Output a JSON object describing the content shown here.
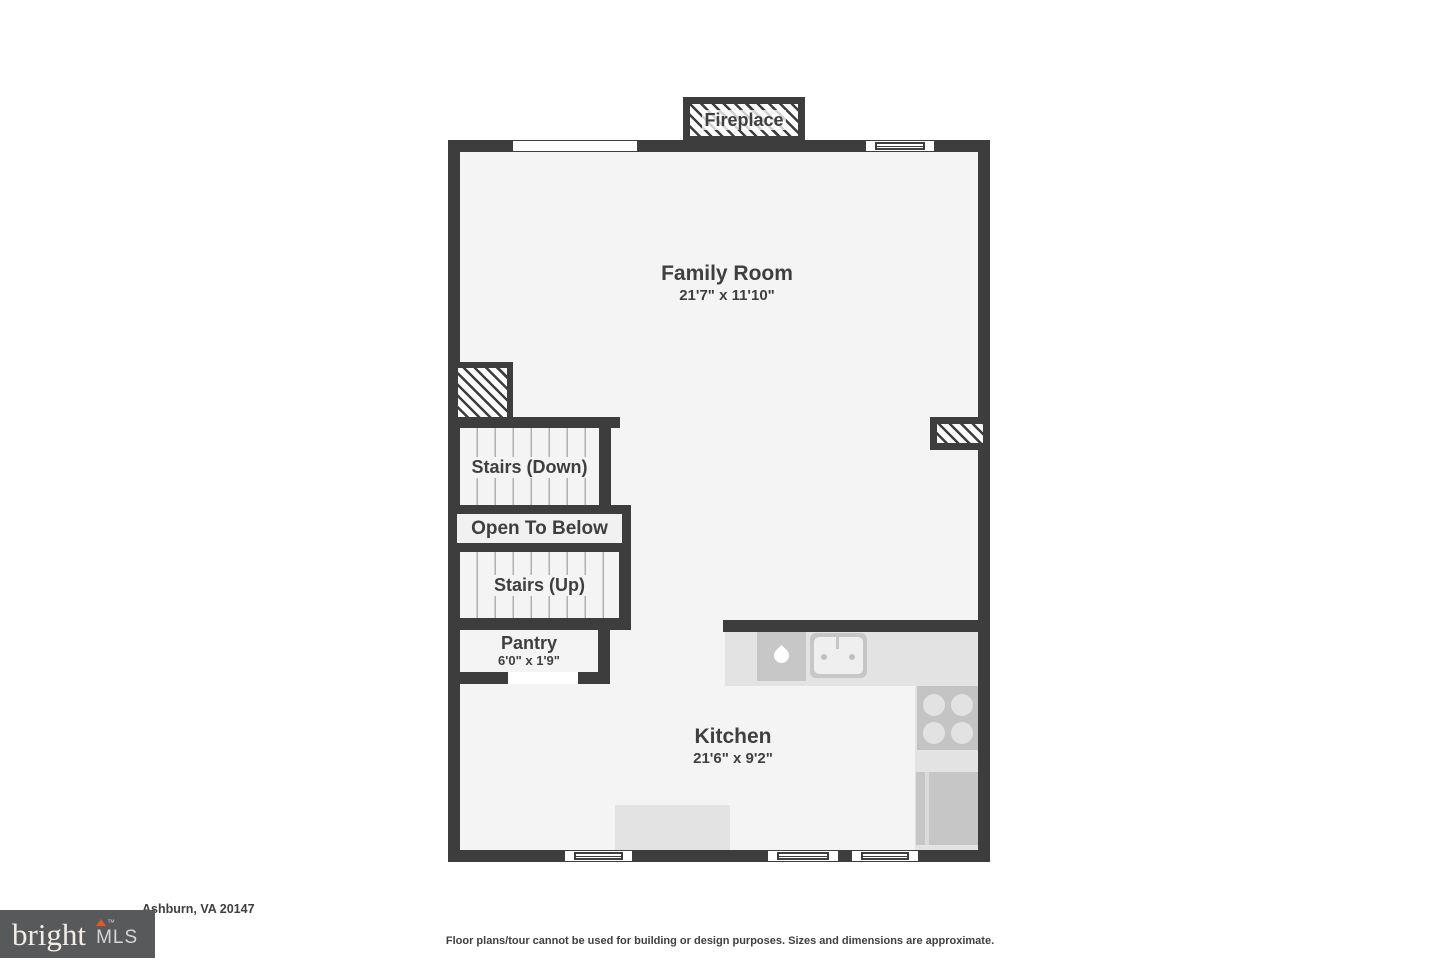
{
  "colors": {
    "wall": "#3d3d3d",
    "floor": "#f4f4f4",
    "counter": "#e3e3e3",
    "appliance": "#c7c7c7",
    "text": "#3f3f3f",
    "logo_bg": "#58595b",
    "logo_text": "#f3eee5",
    "logo_accent": "#e05929",
    "tread_line": "#b0b0b0"
  },
  "plan": {
    "fireplace_label": "Fireplace",
    "family_room": {
      "name": "Family Room",
      "dims": "21'7\" x 11'10\""
    },
    "stairs_down_label": "Stairs (Down)",
    "open_to_below_label": "Open To Below",
    "stairs_up_label": "Stairs (Up)",
    "pantry": {
      "name": "Pantry",
      "dims": "6'0\" x 1'9\""
    },
    "kitchen": {
      "name": "Kitchen",
      "dims": "21'6\" x 9'2\""
    }
  },
  "footer": {
    "address": "Ashburn, VA 20147",
    "logo": {
      "brand": "bright",
      "tm": "™",
      "suffix": "MLS"
    },
    "disclaimer": "Floor plans/tour cannot be used for building or design purposes. Sizes and dimensions are approximate."
  }
}
